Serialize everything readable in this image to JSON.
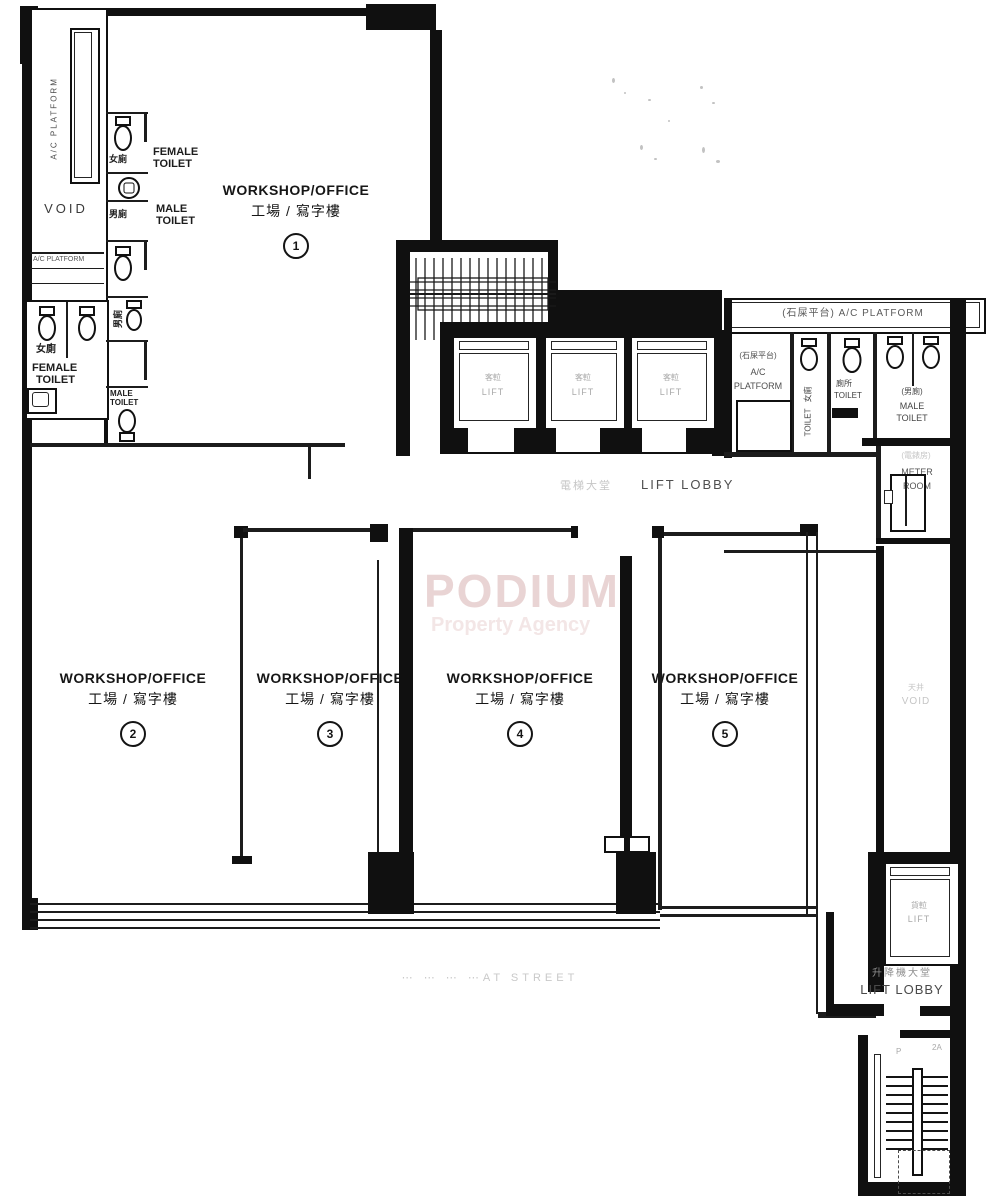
{
  "colors": {
    "ink": "#101010",
    "faint_text": "#a9a9a9",
    "watermark_title": "#e9d4d4",
    "watermark_subtitle": "#f3e6e6"
  },
  "watermark": {
    "title": "PODIUM",
    "subtitle": "Property Agency"
  },
  "units": [
    {
      "en": "WORKSHOP/OFFICE",
      "cn": "工場 / 寫字樓",
      "num": "1"
    },
    {
      "en": "WORKSHOP/OFFICE",
      "cn": "工場 / 寫字樓",
      "num": "2"
    },
    {
      "en": "WORKSHOP/OFFICE",
      "cn": "工場 / 寫字樓",
      "num": "3"
    },
    {
      "en": "WORKSHOP/OFFICE",
      "cn": "工場 / 寫字樓",
      "num": "4"
    },
    {
      "en": "WORKSHOP/OFFICE",
      "cn": "工場 / 寫字樓",
      "num": "5"
    }
  ],
  "left_wing": {
    "vertical_platform": "A/C PLATFORM",
    "void": "VOID",
    "platform_small": "A/C PLATFORM",
    "female_cn": "女廁",
    "female_1": "FEMALE",
    "female_2": "TOILET"
  },
  "toilet_strip": {
    "female_cn": "女廁",
    "female_1": "FEMALE",
    "female_2": "TOILET",
    "male_cn": "男廁",
    "male_1": "MALE",
    "male_2": "TOILET",
    "male_cn_v": "男廁",
    "male_small_1": "MALE",
    "male_small_2": "TOILET"
  },
  "lifts": {
    "car_cn": "客𨋢",
    "car_en": "LIFT"
  },
  "lift_lobby_top": {
    "cn": "電梯大堂",
    "en": "LIFT LOBBY"
  },
  "right_wing": {
    "platform_band": "(石屎平台)  A/C PLATFORM",
    "platform_1": "(石屎平台)",
    "platform_2": "A/C",
    "platform_3": "PLATFORM",
    "strip_cn": "女廁",
    "strip_en": "TOILET",
    "toilet_cn": "廁所",
    "toilet_en": "TOILET",
    "male_cn": "(男廁)",
    "male_1": "MALE",
    "male_2": "TOILET",
    "meter_cn": "(電錶房)",
    "meter_1": "METER",
    "meter_2": "ROOM"
  },
  "corridor": {
    "faint_cn": "天井",
    "faint_en": "VOID"
  },
  "freight_lift": {
    "cn": "貨𨋢",
    "en": "LIFT"
  },
  "lift_lobby_bottom": {
    "cn": "升降機大堂",
    "en": "LIFT LOBBY"
  },
  "stairs": {
    "mark_left": "P",
    "mark_right": "2A"
  },
  "street": {
    "faint": "⋯ ⋯ ⋯ ⋯AT STREET"
  }
}
